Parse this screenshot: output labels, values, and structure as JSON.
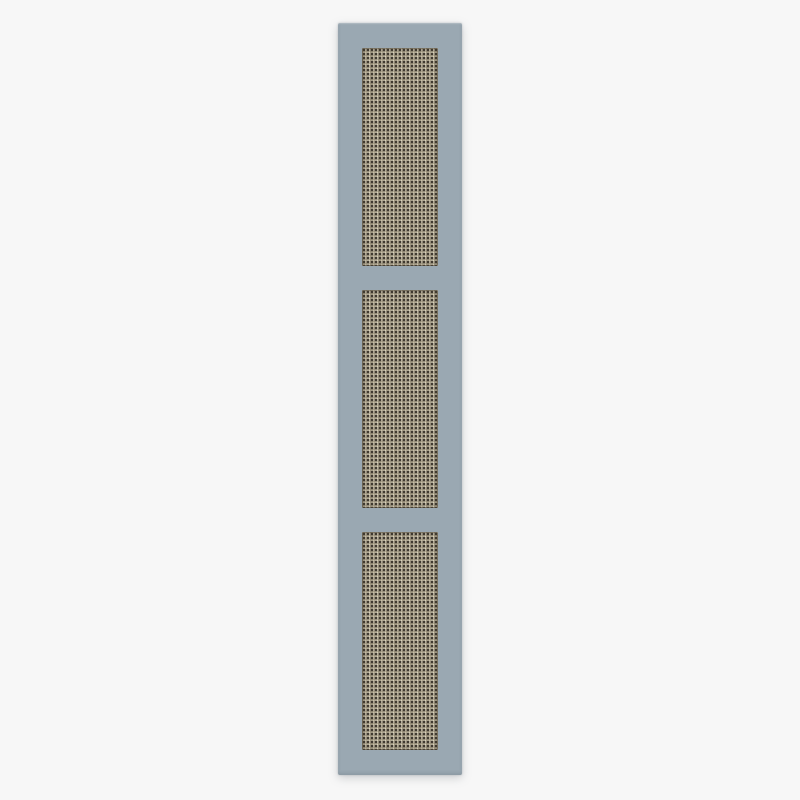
{
  "scene": {
    "type": "product-photo",
    "subject": "Tall narrow vertical furniture panel with a muted blue-gray painted frame and three recessed rectangular cane webbing inserts, photographed on a plain pale gray backdrop",
    "panel": {
      "orientation": "vertical",
      "webbing_sections": 3,
      "material_frame": "painted wood",
      "material_insert": "natural cane webbing"
    },
    "colors": {
      "backdrop": "#f7f7f7",
      "frame": "#9aa8b2",
      "frame_edge": "#8695a0",
      "webbing_base": "#d6cdb5",
      "webbing_strand_light": "#e8e1cc",
      "webbing_strand_dark": "#b1a78d",
      "webbing_hole": "#3d372d"
    }
  }
}
